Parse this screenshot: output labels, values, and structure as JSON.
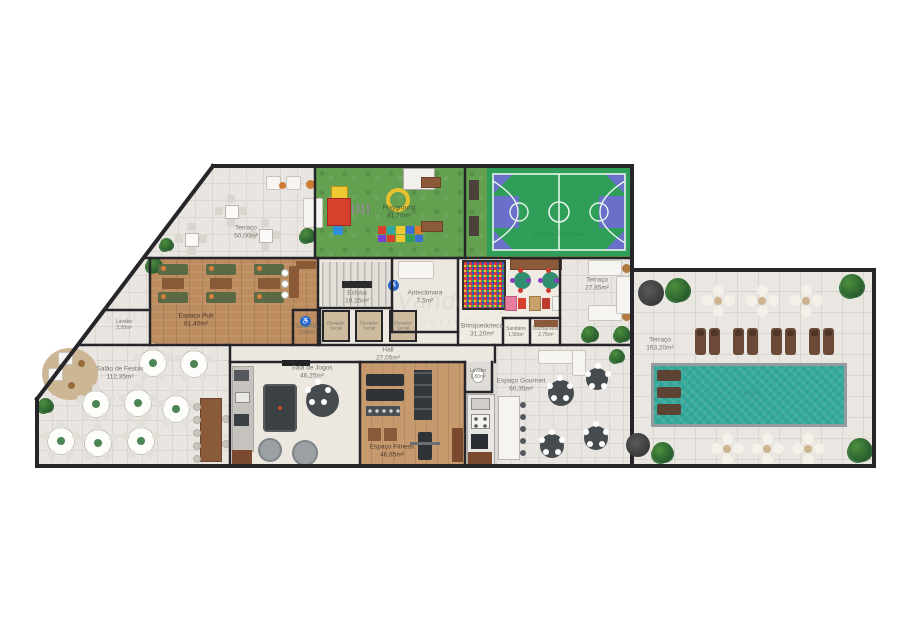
{
  "watermark": {
    "line1": "Vanderley",
    "line2": "corretor"
  },
  "colors": {
    "wall": "#26262a",
    "tile_floor": "#e9e6e2",
    "grass": "#63a050",
    "court_green": "#2f9e58",
    "court_purple": "#6a6fc9",
    "wood": "#bd8c5f",
    "pool_teal": "#35a99b",
    "plant_green": "#2c6330",
    "accessibility_blue": "#2f6fc0"
  },
  "rooms": [
    {
      "name": "Terraço",
      "area": "50,00m²"
    },
    {
      "name": "Playground",
      "area": "81,70m²"
    },
    {
      "name": "Quadra Esportiva",
      "area": ""
    },
    {
      "name": "Espaço Pub",
      "area": "61,40m²"
    },
    {
      "name": "Lavabo",
      "area": "2,30m²"
    },
    {
      "name": "San. PNE",
      "area": "3,04m²"
    },
    {
      "name": "Eclusa",
      "area": "19,15m²"
    },
    {
      "name": "Antecâmara",
      "area": "7,5m²"
    },
    {
      "name": "Elevador",
      "area": "Social"
    },
    {
      "name": "Elevador",
      "area": "Social"
    },
    {
      "name": "Elevador",
      "area": "Social"
    },
    {
      "name": "Hall",
      "area": "27,05m²"
    },
    {
      "name": "Brinquedoteca",
      "area": "31,20m²"
    },
    {
      "name": "Sanitário",
      "area": "1,50m²"
    },
    {
      "name": "Ducha/Vest.",
      "area": "2,75m²"
    },
    {
      "name": "Terraço",
      "area": "27,85m²"
    },
    {
      "name": "Salão de Festas",
      "area": "112,35m²"
    },
    {
      "name": "Sala de Jogos",
      "area": "46,25m²"
    },
    {
      "name": "Espaço Fitness",
      "area": "46,85m²"
    },
    {
      "name": "Lavabo",
      "area": "1,80m²"
    },
    {
      "name": "Espaço Gourmet",
      "area": "60,35m²"
    },
    {
      "name": "Terraço",
      "area": "163,20m²"
    },
    {
      "name": "Piscina",
      "area": ""
    }
  ],
  "icons": {
    "accessibility": "♿"
  }
}
